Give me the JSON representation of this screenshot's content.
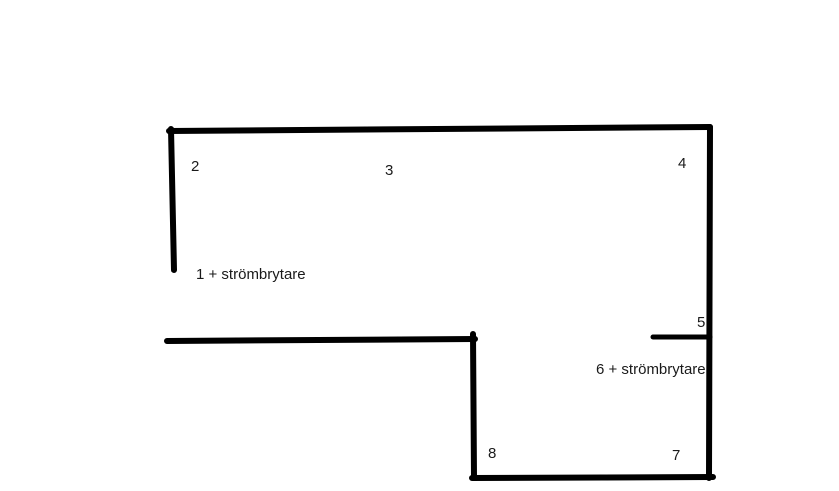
{
  "canvas": {
    "width": 839,
    "height": 491,
    "background_color": "#ffffff",
    "ink_color": "#000000",
    "text_color": "#1a1a1a"
  },
  "diagram": {
    "type": "floor-plan-sketch",
    "description": "Hand-drawn L-shaped room outline with numbered electrical outlet positions",
    "walls": [
      {
        "name": "wall-top",
        "x1": 169,
        "y1": 131,
        "x2": 710,
        "y2": 127,
        "thickness": 6
      },
      {
        "name": "wall-left",
        "x1": 171,
        "y1": 129,
        "x2": 174,
        "y2": 270,
        "thickness": 6
      },
      {
        "name": "wall-right",
        "x1": 710,
        "y1": 127,
        "x2": 709,
        "y2": 478,
        "thickness": 6
      },
      {
        "name": "wall-middle-horizontal",
        "x1": 167,
        "y1": 341,
        "x2": 475,
        "y2": 339,
        "thickness": 6
      },
      {
        "name": "wall-middle-vertical",
        "x1": 473,
        "y1": 334,
        "x2": 474,
        "y2": 477,
        "thickness": 6
      },
      {
        "name": "wall-bottom",
        "x1": 472,
        "y1": 478,
        "x2": 713,
        "y2": 477,
        "thickness": 6
      },
      {
        "name": "wall-outlet-5-stub",
        "x1": 653,
        "y1": 337,
        "x2": 710,
        "y2": 337,
        "thickness": 5
      }
    ],
    "labels": [
      {
        "name": "outlet-2-label",
        "text": "2",
        "x": 191,
        "y": 158
      },
      {
        "name": "outlet-3-label",
        "text": "3",
        "x": 385,
        "y": 162
      },
      {
        "name": "outlet-4-label",
        "text": "4",
        "x": 678,
        "y": 155
      },
      {
        "name": "outlet-1-switch-label",
        "text": "1 + strömbrytare",
        "x": 196,
        "y": 266
      },
      {
        "name": "outlet-5-label",
        "text": "5",
        "x": 697,
        "y": 314
      },
      {
        "name": "outlet-6-switch-label",
        "text": "6 + strömbrytare",
        "x": 596,
        "y": 361
      },
      {
        "name": "outlet-8-label",
        "text": "8",
        "x": 488,
        "y": 445
      },
      {
        "name": "outlet-7-label",
        "text": "7",
        "x": 672,
        "y": 447
      }
    ]
  }
}
